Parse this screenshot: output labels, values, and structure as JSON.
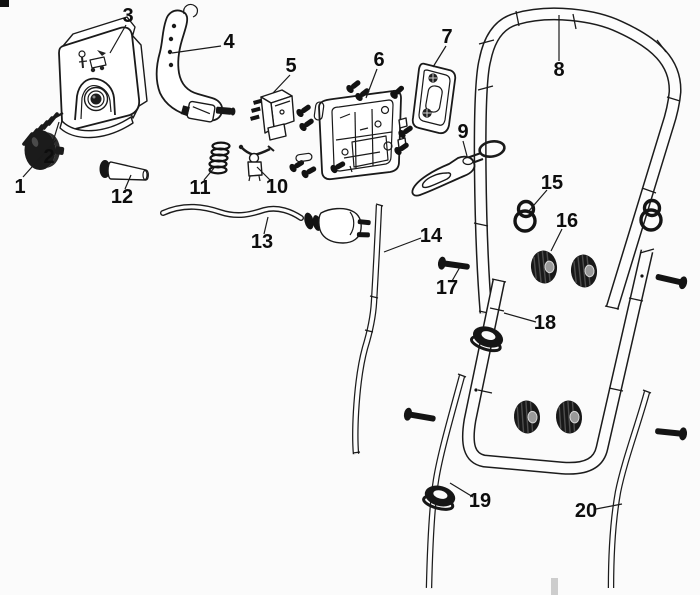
{
  "page": {
    "background_color": "#fbfbfb",
    "ink_color": "#1a1a1a",
    "corner_mark_color": "#111111",
    "watermark_color": "#cdcdcd"
  },
  "diagram": {
    "type": "exploded-parts-diagram",
    "canvas": {
      "width": 700,
      "height": 595
    },
    "callouts": [
      {
        "num": "1",
        "part": "cap-knob",
        "x": 20,
        "y": 187,
        "leader": [
          23,
          177,
          56,
          140
        ]
      },
      {
        "num": "2",
        "part": "spring-small",
        "x": 49,
        "y": 157,
        "leader": [
          51,
          148,
          59,
          122
        ]
      },
      {
        "num": "3",
        "part": "switch-housing-cover",
        "x": 128,
        "y": 16,
        "leader": [
          126,
          25,
          110,
          53
        ]
      },
      {
        "num": "4",
        "part": "start-lever",
        "x": 229,
        "y": 42,
        "leader": [
          221,
          46,
          172,
          53
        ]
      },
      {
        "num": "5",
        "part": "switch-block",
        "x": 291,
        "y": 66,
        "leader": [
          290,
          75,
          273,
          93
        ]
      },
      {
        "num": "6",
        "part": "switchbox-housing",
        "x": 379,
        "y": 60,
        "leader": [
          377,
          69,
          366,
          98
        ]
      },
      {
        "num": "7",
        "part": "cover-plate",
        "x": 447,
        "y": 37,
        "leader": [
          446,
          46,
          433,
          67
        ]
      },
      {
        "num": "8",
        "part": "upper-handle-bar",
        "x": 559,
        "y": 70,
        "leader": [
          559,
          61,
          559,
          15
        ]
      },
      {
        "num": "9",
        "part": "cable-guide-bracket",
        "x": 463,
        "y": 132,
        "leader": [
          463,
          141,
          467,
          156
        ]
      },
      {
        "num": "10",
        "part": "lever-switch",
        "x": 277,
        "y": 187,
        "leader": [
          271,
          181,
          257,
          167
        ]
      },
      {
        "num": "11",
        "part": "spring-coil",
        "x": 200,
        "y": 188,
        "leader": [
          204,
          180,
          214,
          168
        ]
      },
      {
        "num": "12",
        "part": "pin-bushing",
        "x": 122,
        "y": 197,
        "leader": [
          125,
          189,
          131,
          175
        ]
      },
      {
        "num": "13",
        "part": "power-cable-plug",
        "x": 262,
        "y": 242,
        "leader": [
          264,
          234,
          268,
          217
        ]
      },
      {
        "num": "14",
        "part": "control-rod",
        "x": 431,
        "y": 236,
        "leader": [
          421,
          238,
          384,
          252
        ]
      },
      {
        "num": "15",
        "part": "cable-hook-ring",
        "x": 552,
        "y": 183,
        "leader": [
          547,
          190,
          528,
          212
        ]
      },
      {
        "num": "16",
        "part": "wing-knob",
        "x": 567,
        "y": 221,
        "leader": [
          562,
          229,
          551,
          251
        ]
      },
      {
        "num": "17",
        "part": "carriage-bolt",
        "x": 447,
        "y": 288,
        "leader": [
          452,
          281,
          460,
          267
        ]
      },
      {
        "num": "18",
        "part": "lower-handle-bar",
        "x": 545,
        "y": 323,
        "leader": [
          536,
          322,
          504,
          313
        ]
      },
      {
        "num": "19",
        "part": "rod-with-clamp",
        "x": 480,
        "y": 501,
        "leader": [
          473,
          497,
          450,
          483
        ]
      },
      {
        "num": "20",
        "part": "handle-tube-right",
        "x": 586,
        "y": 511,
        "leader": [
          596,
          509,
          622,
          504
        ]
      }
    ]
  }
}
